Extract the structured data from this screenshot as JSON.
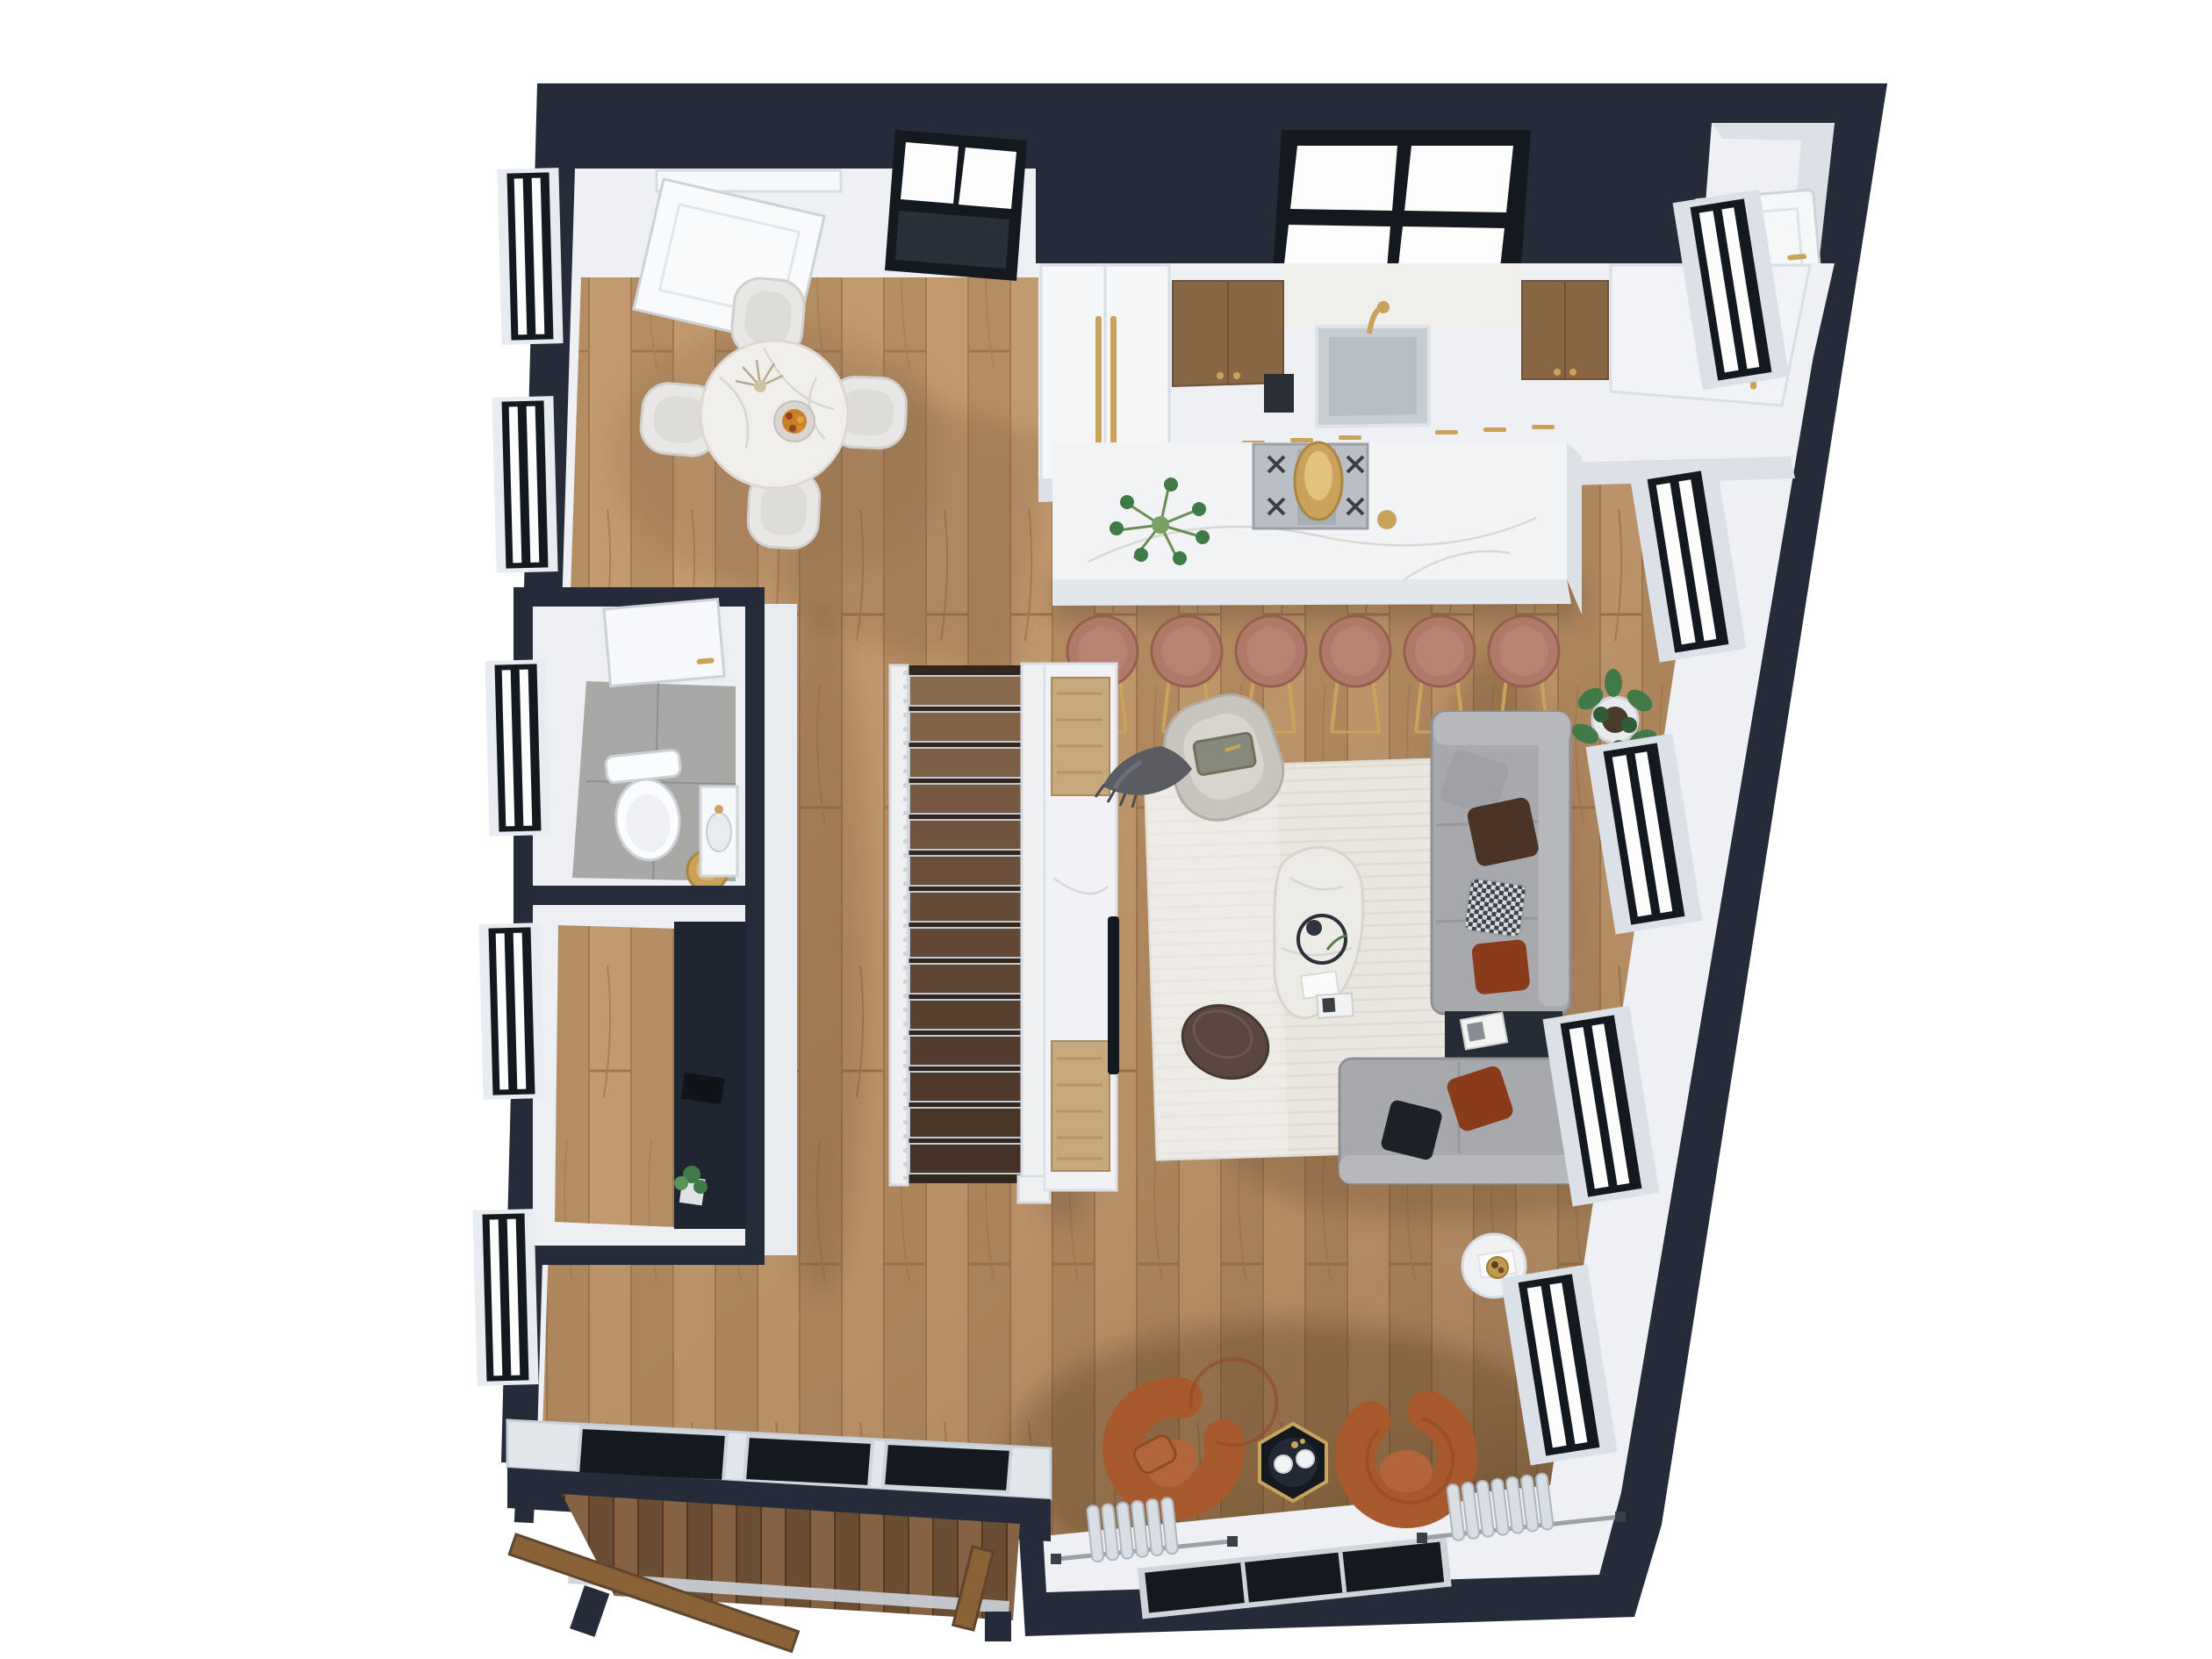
{
  "title": "3D top-down floor plan render of an open-plan loft apartment",
  "palette": {
    "wall_dark": "#252b39",
    "wall_face": "#eef0f4",
    "cabinet_white": "#eef0f3",
    "island": "#f2f3f5",
    "floor_wood": "#bd9469",
    "deck_wood": "#7a5a3d",
    "rug": "#eae7e0",
    "sofa": "#a7a9ad",
    "marble": "#f0efec",
    "tile": "#a8a8a6",
    "stool": "#b07a68",
    "cognac": "#a9592e",
    "wood_cabinet": "#8a6744",
    "gold": "#c9a35c",
    "frame": "#14181f",
    "glass": "#fdfdfe",
    "curtain": "#d9dee4",
    "plant": "#3f7a47",
    "ottoman": "#5a4741",
    "panel_tan": "#c8a97e",
    "cushion_rust": "#8a3c1a",
    "cushion_brown": "#4a3324",
    "cushion_black": "#1d2026"
  },
  "labels": {
    "plan": "3d-floor-plan-top-down-render",
    "entry": "entry-hall",
    "dining": "dining-area",
    "kitchen": "kitchen-run",
    "kitchen_island": "kitchen-island-with-bar-stools",
    "bathroom": "bathroom",
    "nook": "built-in-desk-nook",
    "stairs": "staircase",
    "media_wall": "media-wall-with-tv",
    "living": "living-area",
    "lounge": "window-lounge-corner",
    "balcony": "balcony-deck"
  },
  "counts": {
    "bar_stools": 6,
    "dining_chairs": 4,
    "stair_treads": 14,
    "left_wall_windows": 5,
    "right_wall_windows": 5,
    "skylight_windows": 2,
    "lounge_chairs": 2,
    "balcony_glass_panels": 3,
    "sofa_sections": 2
  }
}
